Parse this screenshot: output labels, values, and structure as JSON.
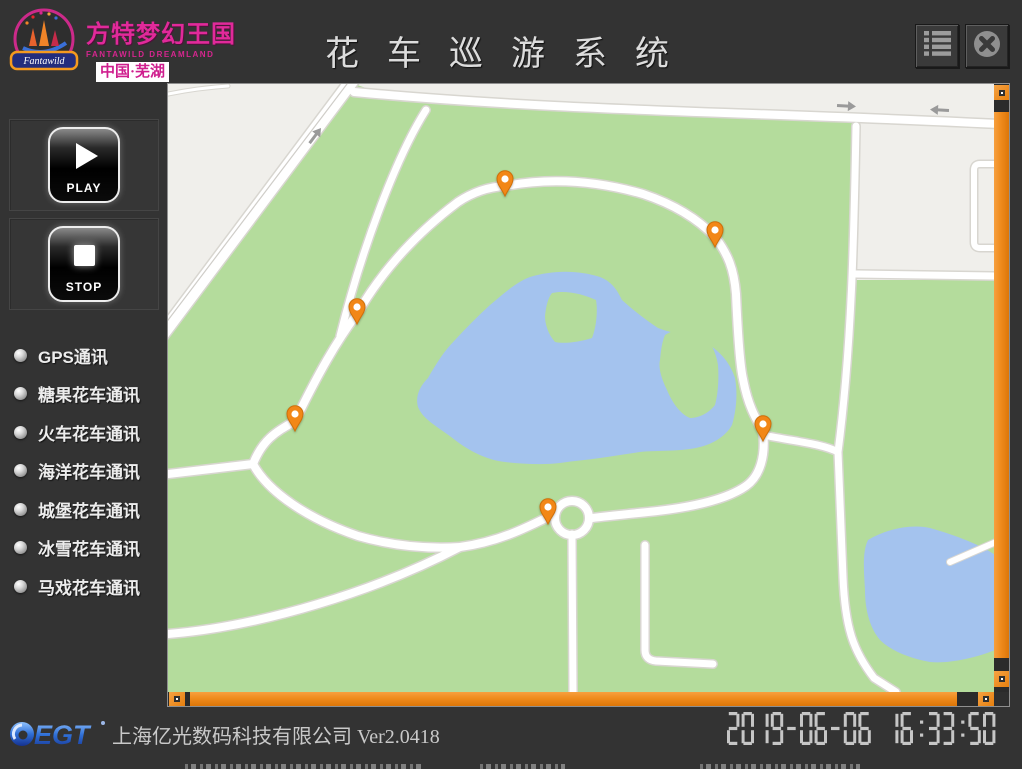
{
  "header": {
    "brand": {
      "name_cn": "方特梦幻王国",
      "name_en": "FANTAWILD DREAMLAND",
      "location": "中国·芜湖",
      "banner_script": "Fantawild"
    },
    "title": "花车巡游系统",
    "menu_button": {
      "icon": "list-icon"
    },
    "close_button": {
      "icon": "close-icon"
    }
  },
  "sidebar": {
    "play": {
      "label": "PLAY",
      "icon": "play-icon"
    },
    "stop": {
      "label": "STOP",
      "icon": "stop-icon"
    },
    "status_items": [
      {
        "label": "GPS通讯",
        "state": "idle"
      },
      {
        "label": "糖果花车通讯",
        "state": "idle"
      },
      {
        "label": "火车花车通讯",
        "state": "idle"
      },
      {
        "label": "海洋花车通讯",
        "state": "idle"
      },
      {
        "label": "城堡花车通讯",
        "state": "idle"
      },
      {
        "label": "冰雪花车通讯",
        "state": "idle"
      },
      {
        "label": "马戏花车通讯",
        "state": "idle"
      }
    ]
  },
  "map": {
    "pins": [
      {
        "x": 337,
        "y": 112
      },
      {
        "x": 547,
        "y": 163
      },
      {
        "x": 189,
        "y": 240
      },
      {
        "x": 127,
        "y": 347
      },
      {
        "x": 595,
        "y": 357
      },
      {
        "x": 380,
        "y": 440
      }
    ],
    "colors": {
      "park_green": "#b4dc9c",
      "water_blue": "#a4c3ee",
      "road_white": "#ffffff",
      "road_casing": "#d8d6d0",
      "background_gray": "#f0efeb",
      "pin_orange": "#f28717"
    }
  },
  "scrollbar": {
    "accent_orange": "#ef8b1d"
  },
  "footer": {
    "logo_text": "EGT",
    "company": "上海亿光数码科技有限公司",
    "version": "Ver2.0418",
    "datetime": "2019-06-06 16:33:50"
  }
}
